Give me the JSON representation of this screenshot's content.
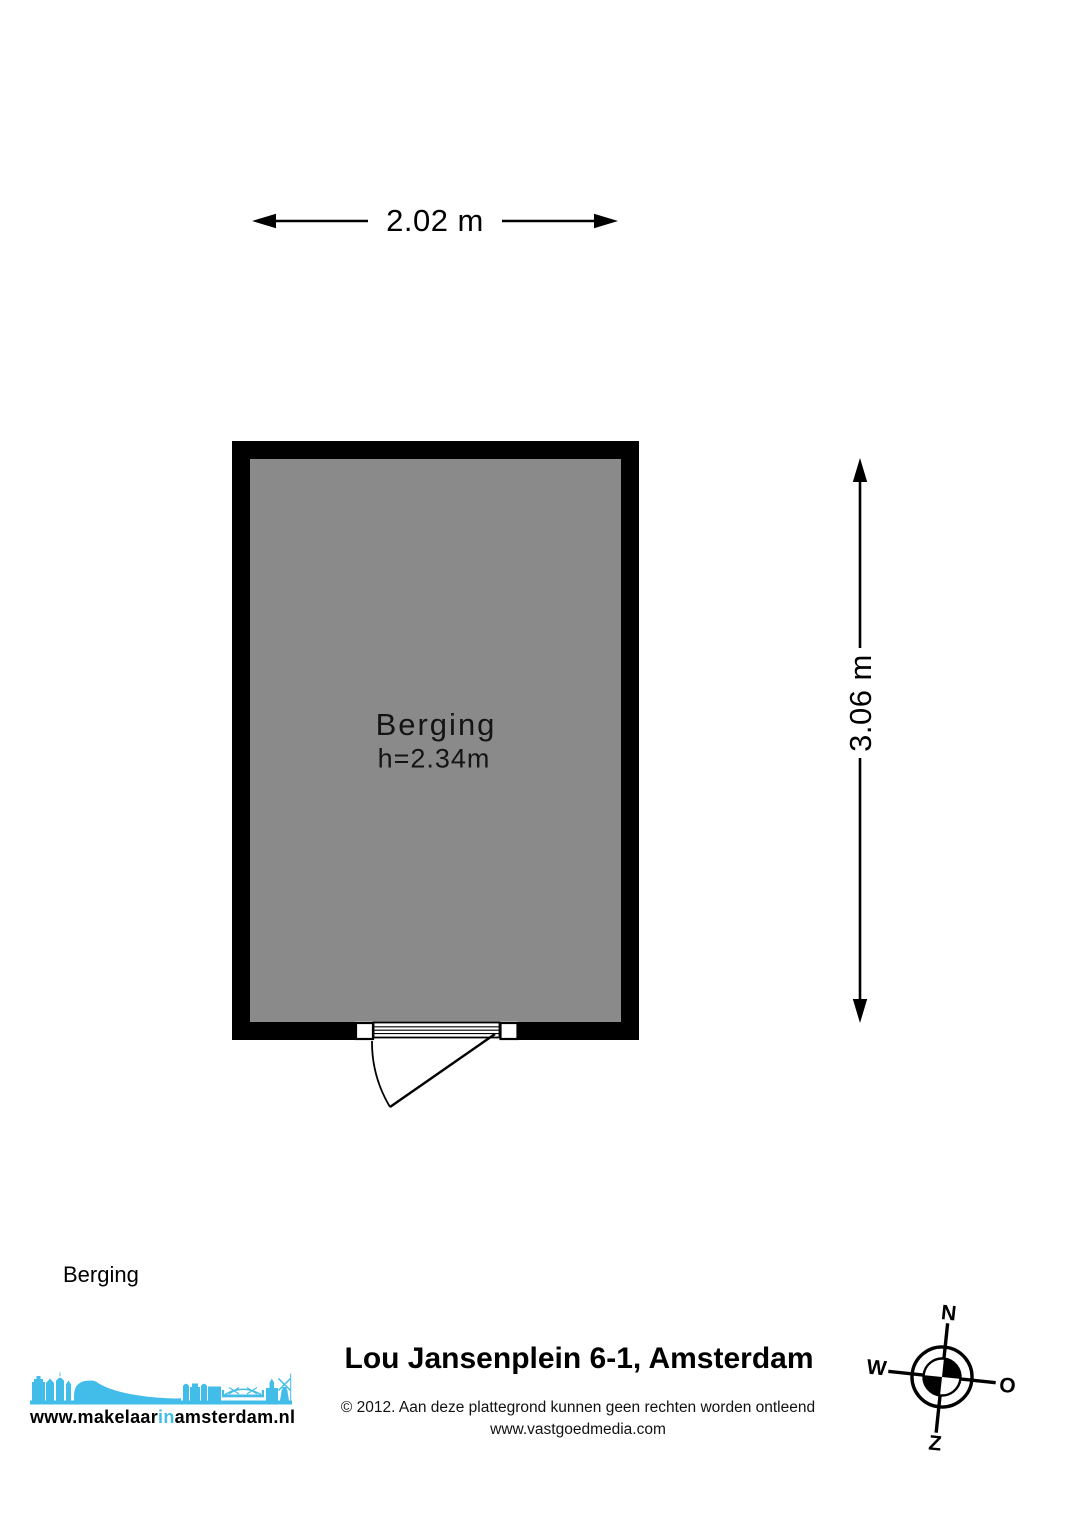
{
  "plan": {
    "dimensions": {
      "width": "2.02 m",
      "height": "3.06 m"
    },
    "room": {
      "name": "Berging",
      "ceiling_height": "h=2.34m",
      "floor_color": "#8a8a8a",
      "wall_color": "#000000"
    },
    "floor_label": "Berging"
  },
  "footer": {
    "title": "Lou Jansenplein 6-1, Amsterdam",
    "disclaimer": "© 2012. Aan deze plattegrond kunnen geen rechten worden ontleend",
    "website": "www.vastgoedmedia.com"
  },
  "logo": {
    "text_prefix": "www.makelaar",
    "text_highlight": "in",
    "text_suffix": "amsterdam.nl",
    "brand_color": "#42bde9"
  },
  "compass": {
    "north": "N",
    "east": "O",
    "south": "Z",
    "west": "W"
  }
}
